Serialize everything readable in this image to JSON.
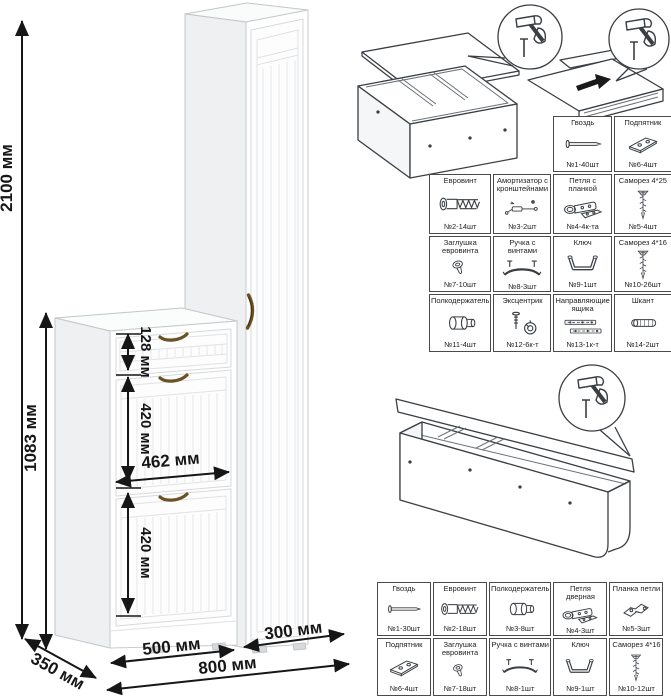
{
  "illustration": {
    "dims": {
      "height_total": "2100 мм",
      "height_lower": "1083 мм",
      "drawer_height": "128 мм",
      "door_upper_height": "420 мм",
      "inner_width": "462 мм",
      "door_lower_height": "420 мм",
      "width_left": "500 мм",
      "width_right": "300 мм",
      "width_total": "800 мм",
      "depth": "350 мм"
    },
    "colors": {
      "handle": "#6b5124",
      "cabinet_side": "#eef0f2",
      "dimension_line": "#161616"
    }
  },
  "hardware_tables": {
    "upper": {
      "rows": [
        {
          "cells": [
            {
              "label": "Гвоздь",
              "qty": "№1-40шт",
              "icon": "nail-icon"
            },
            {
              "label": "Подпятник",
              "qty": "№6-4шт",
              "icon": "foot-plate-icon"
            }
          ]
        },
        {
          "cells": [
            {
              "label": "Евровинт",
              "qty": "№2-14шт",
              "icon": "euro-screw-icon"
            },
            {
              "label": "Амортизатор с кронштейнами",
              "qty": "№3-2шт",
              "icon": "gas-lift-icon"
            },
            {
              "label": "Петля с планкой",
              "qty": "№4-4к-та",
              "icon": "hinge-icon"
            },
            {
              "label": "Саморез 4*25",
              "qty": "№5-4шт",
              "icon": "screw-icon"
            }
          ]
        },
        {
          "cells": [
            {
              "label": "Заглушка евровинта",
              "qty": "№7-10шт",
              "icon": "cap-icon"
            },
            {
              "label": "Ручка с винтами",
              "qty": "№8-3шт",
              "icon": "handle-icon"
            },
            {
              "label": "Ключ",
              "qty": "№9-1шт",
              "icon": "hex-key-icon"
            },
            {
              "label": "Саморез 4*16",
              "qty": "№10-26шт",
              "icon": "screw-icon"
            }
          ]
        },
        {
          "cells": [
            {
              "label": "Полкодержатель",
              "qty": "№11-4шт",
              "icon": "shelf-pin-icon"
            },
            {
              "label": "Эксцентрик",
              "qty": "№12-6к-т",
              "icon": "cam-lock-icon"
            },
            {
              "label": "Направляющие ящика",
              "qty": "№13-1к-т",
              "icon": "drawer-slides-icon"
            },
            {
              "label": "Шкант",
              "qty": "№14-2шт",
              "icon": "dowel-icon"
            }
          ]
        }
      ]
    },
    "lower": {
      "rows": [
        {
          "cells": [
            {
              "label": "Гвоздь",
              "qty": "№1-30шт",
              "icon": "nail-icon"
            },
            {
              "label": "Евровинт",
              "qty": "№2-18шт",
              "icon": "euro-screw-icon"
            },
            {
              "label": "Полкодержатель",
              "qty": "№3-8шт",
              "icon": "shelf-pin-icon"
            },
            {
              "label": "Петля дверная",
              "qty": "№4-3шт",
              "icon": "hinge-icon"
            },
            {
              "label": "Планка петли",
              "qty": "№5-3шт",
              "icon": "hinge-plate-icon"
            }
          ]
        },
        {
          "cells": [
            {
              "label": "Подпятник",
              "qty": "№6-4шт",
              "icon": "foot-plate-icon"
            },
            {
              "label": "Заглушка евровинта",
              "qty": "№7-18шт",
              "icon": "cap-icon"
            },
            {
              "label": "Ручка с винтами",
              "qty": "№8-1шт",
              "icon": "handle-icon"
            },
            {
              "label": "Ключ",
              "qty": "№9-1шт",
              "icon": "hex-key-icon"
            },
            {
              "label": "Саморез 4*16",
              "qty": "№10-12шт",
              "icon": "screw-icon"
            }
          ]
        }
      ]
    }
  }
}
